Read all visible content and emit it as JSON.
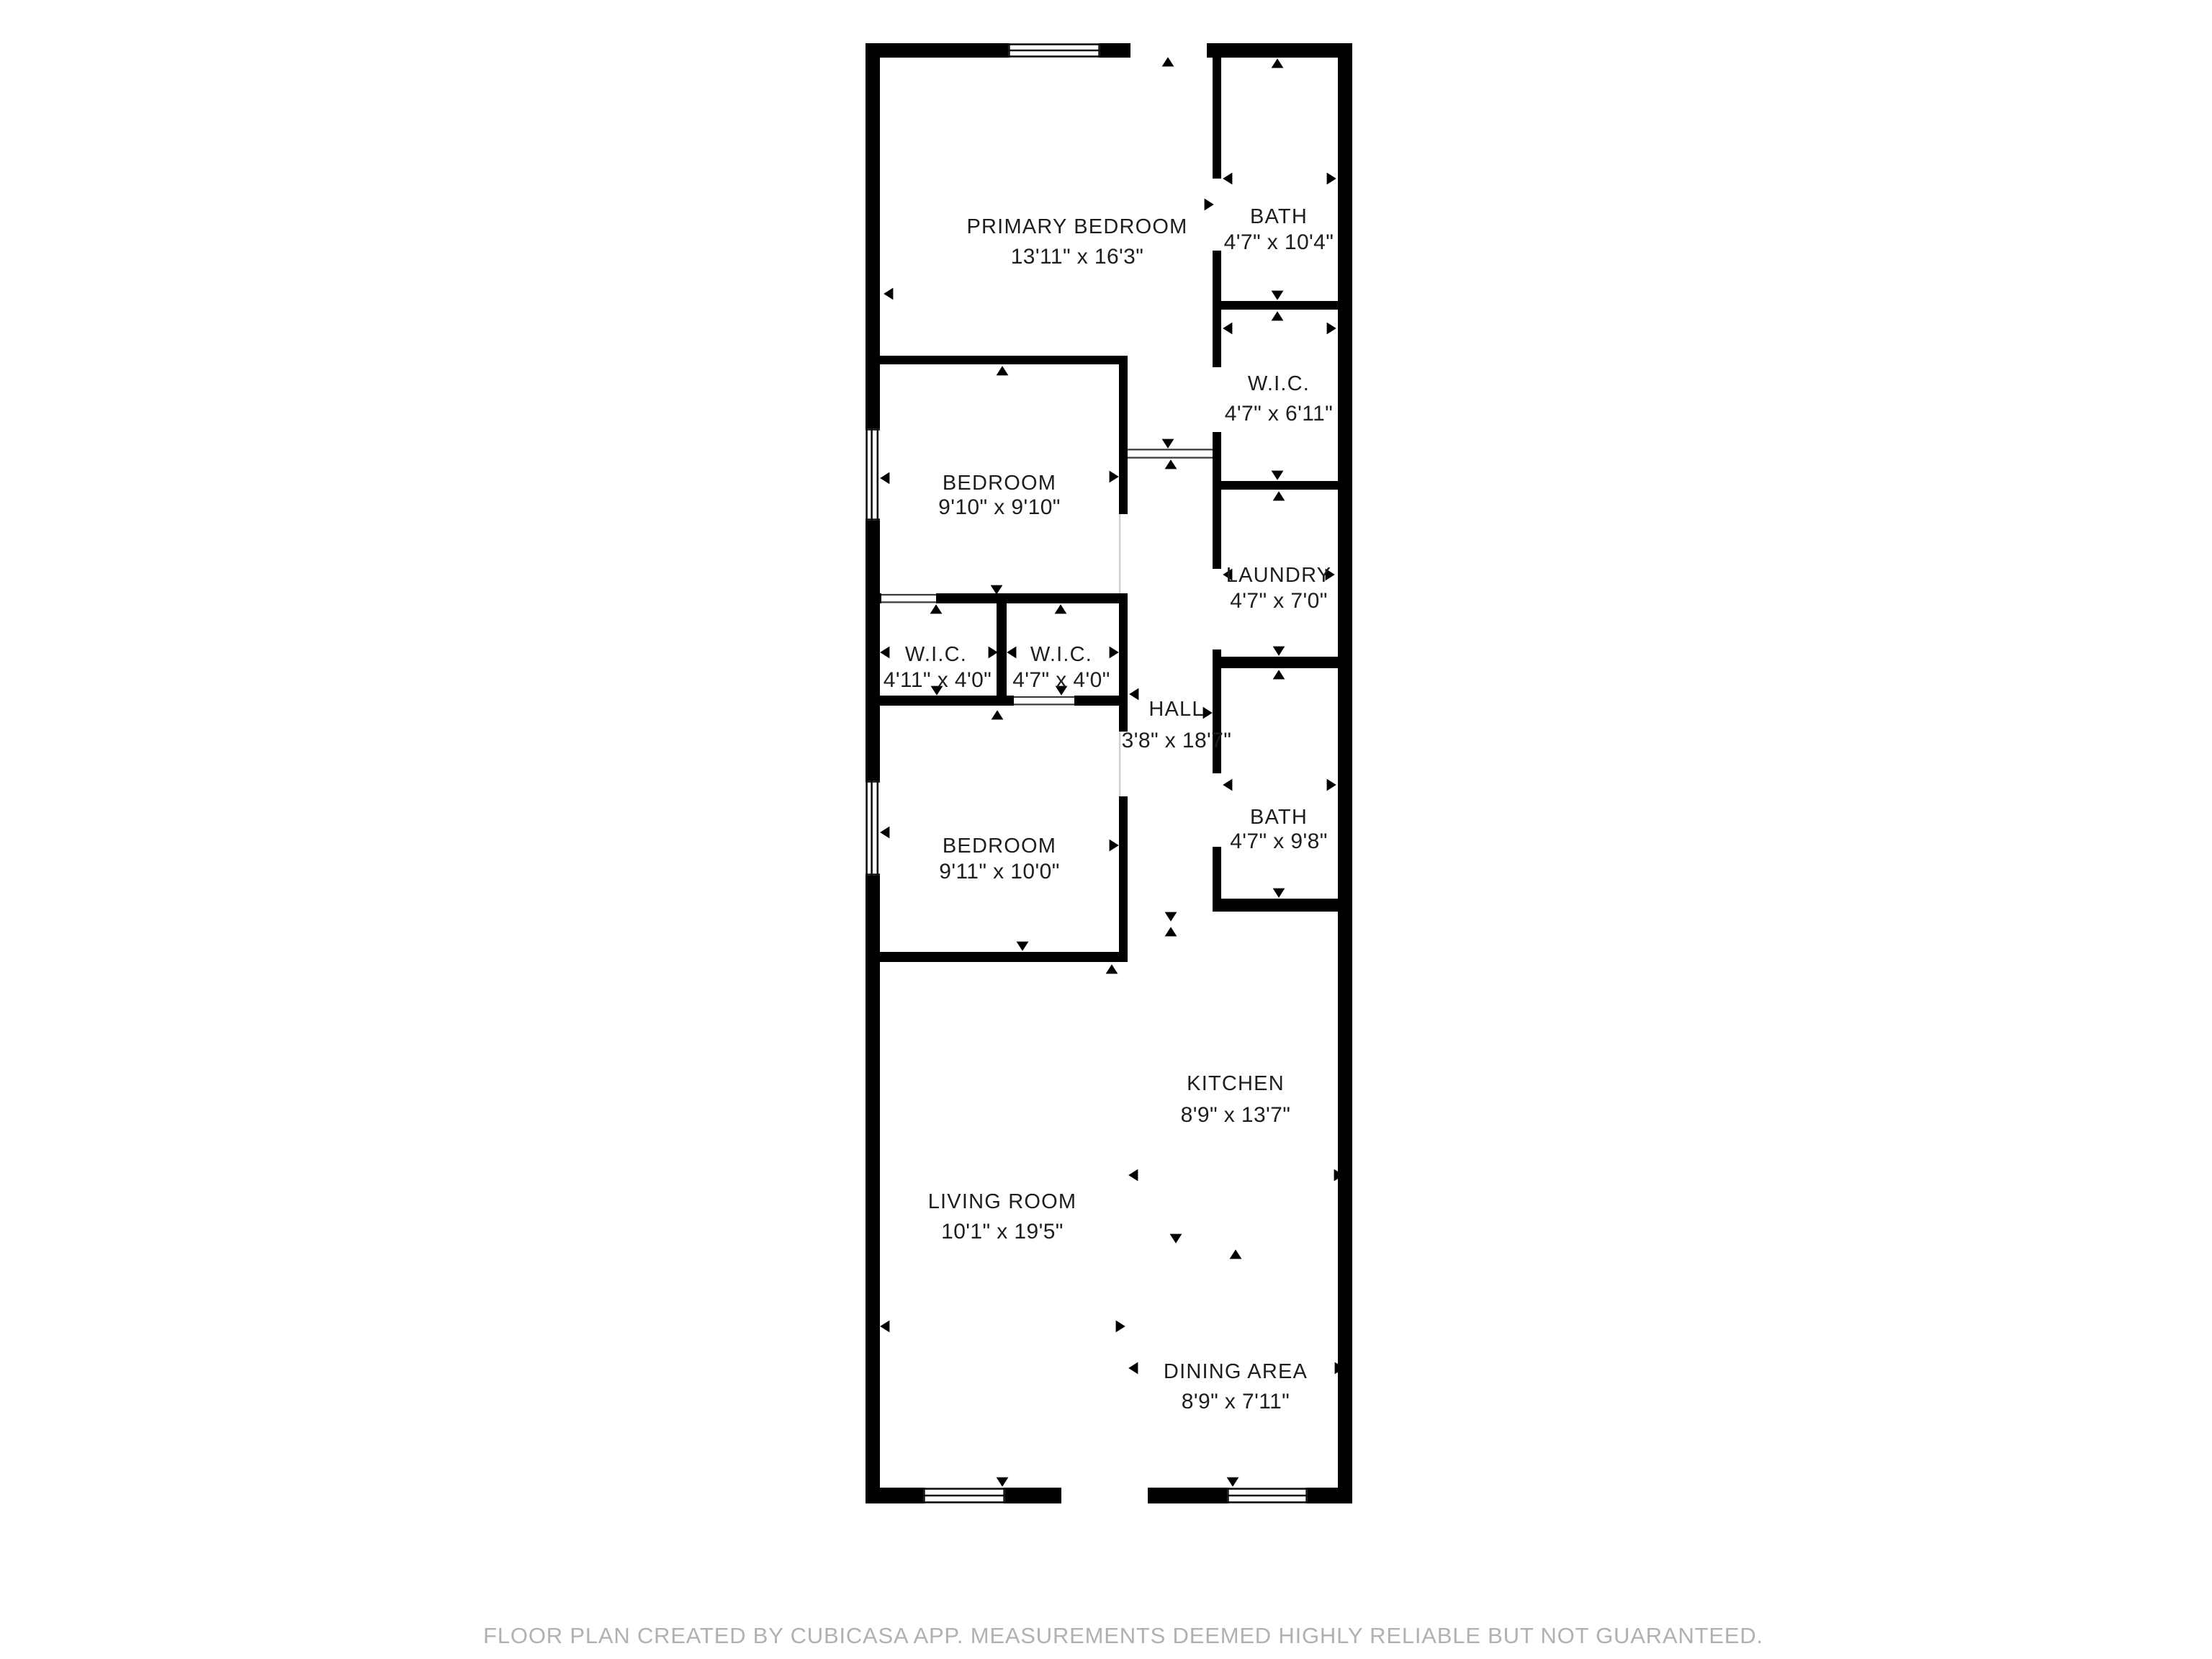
{
  "colors": {
    "wall": "#000000",
    "label_text": "#1e1e1e",
    "footer_text": "#b1b1b1",
    "background": "#ffffff"
  },
  "rooms": [
    {
      "id": "primary-bedroom",
      "name": "PRIMARY BEDROOM",
      "dims": "13'11\" x 16'3\""
    },
    {
      "id": "bath",
      "name": "BATH",
      "dims": "4'7\" x 10'4\""
    },
    {
      "id": "wic-right",
      "name": "W.I.C.",
      "dims": "4'7\" x 6'11\""
    },
    {
      "id": "bedroom",
      "name": "BEDROOM",
      "dims": "9'10\" x 9'10\""
    },
    {
      "id": "laundry",
      "name": "LAUNDRY",
      "dims": "4'7\" x 7'0\""
    },
    {
      "id": "wic-left-1",
      "name": "W.I.C.",
      "dims": "4'11\" x 4'0\""
    },
    {
      "id": "wic-left-2",
      "name": "W.I.C.",
      "dims": "4'7\" x 4'0\""
    },
    {
      "id": "hall",
      "name": "HALL",
      "dims": "3'8\" x 18'7\""
    },
    {
      "id": "bedroom-2",
      "name": "BEDROOM",
      "dims": "9'11\" x 10'0\""
    },
    {
      "id": "bath-2",
      "name": "BATH",
      "dims": "4'7\" x 9'8\""
    },
    {
      "id": "kitchen",
      "name": "KITCHEN",
      "dims": "8'9\" x 13'7\""
    },
    {
      "id": "living-room",
      "name": "LIVING ROOM",
      "dims": "10'1\" x 19'5\""
    },
    {
      "id": "dining-area",
      "name": "DINING AREA",
      "dims": "8'9\" x 7'11\""
    }
  ],
  "footer": {
    "text": "FLOOR PLAN CREATED BY CUBICASA APP. MEASUREMENTS DEEMED HIGHLY RELIABLE BUT NOT GUARANTEED."
  }
}
